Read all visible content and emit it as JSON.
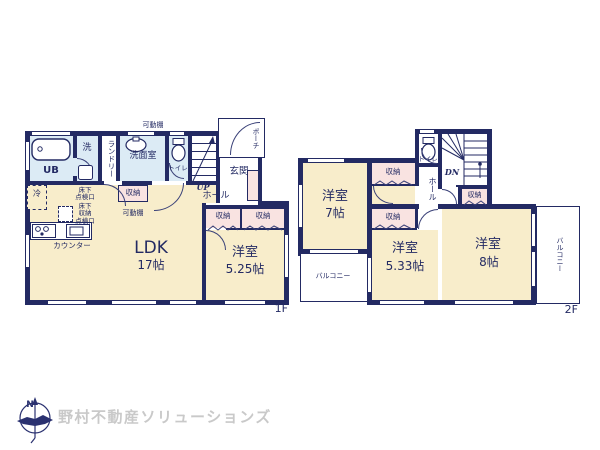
{
  "colors": {
    "wall": "#232a63",
    "room_cream": "#f8edcb",
    "wet_blue": "#dcebf5",
    "closet_pink": "#f9e3e1",
    "logo_gray": "#c9c9c9"
  },
  "floor1": {
    "floor_label": "1F",
    "bath": "UB",
    "wash": "洗",
    "laundry": "ランドリー",
    "washroom": "洗面室",
    "toilet": "トイレ",
    "shelf_top": "可動棚",
    "shelf_mid": "可動棚",
    "stairs": "UP",
    "hall": "ホール",
    "entrance": "玄関",
    "porch": "ポーチ",
    "fridge": "冷",
    "underfloor_hatch": "床下\n点検口",
    "underfloor_storage": "床下\n収納\n点検口",
    "storage_mid": "収納",
    "counter": "カウンター",
    "ldk_name": "LDK",
    "ldk_size": "17帖",
    "bedroom_name": "洋室",
    "bedroom_size": "5.25帖",
    "storage_a": "収納",
    "storage_b": "収納"
  },
  "floor2": {
    "floor_label": "2F",
    "bedroom7_name": "洋室",
    "bedroom7_size": "7帖",
    "bedroom533_name": "洋室",
    "bedroom533_size": "5.33帖",
    "bedroom8_name": "洋室",
    "bedroom8_size": "8帖",
    "toilet": "トイレ",
    "stairs": "DN",
    "hall": "ホール",
    "storage_top": "収納",
    "storage_mid": "収納",
    "storage_hall": "収納",
    "balcony_left": "バルコニー",
    "balcony_right": "バルコニー"
  },
  "footer": {
    "compass_north": "N",
    "brand": "野村不動産ソリューションズ"
  }
}
